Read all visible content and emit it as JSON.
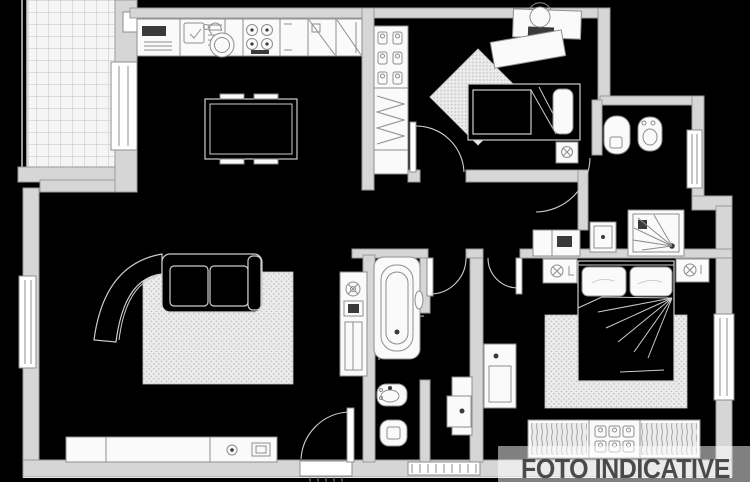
{
  "watermark": {
    "text": "FOTO INDICATIVE"
  },
  "palette": {
    "background": "#000000",
    "wall_fill": "#d6d6d6",
    "wall_stroke": "#9a9a9a",
    "line": "#8d8d8d",
    "line_light": "#cdcdcd",
    "fixture_fill": "#fafafa",
    "dark_fill": "#3a3a3a",
    "rug_fill": "#ececec",
    "rug_dot": "#c4c4c4",
    "tile_fill": "#f5f5f5",
    "tile_line": "#c3c3c3",
    "watermark_color": "#4a4a4a",
    "watermark_band": "rgba(255,255,255,0.5)"
  },
  "rooms": [
    {
      "id": "terrace",
      "features": [
        "tiled-floor",
        "railing",
        "french-door"
      ]
    },
    {
      "id": "kitchen-dining",
      "features": [
        "kitchen-counter",
        "sink",
        "cooktop",
        "appliance-cabinets",
        "kettle",
        "dining-table"
      ]
    },
    {
      "id": "living-room",
      "features": [
        "corner-sofa",
        "rug",
        "sideboard",
        "tv",
        "speaker",
        "shelf-cabinet",
        "plant",
        "window",
        "entrance-door"
      ]
    },
    {
      "id": "bedroom-small",
      "features": [
        "wardrobe-column",
        "single-bed",
        "nightstand",
        "desk",
        "desk-chair",
        "rug",
        "door"
      ]
    },
    {
      "id": "bathroom-main",
      "features": [
        "bathtub",
        "washbasin",
        "toilet",
        "door"
      ]
    },
    {
      "id": "bathroom-second",
      "features": [
        "toilet",
        "bidet",
        "shower",
        "washbasin",
        "window",
        "door"
      ]
    },
    {
      "id": "hallway",
      "features": [
        "console"
      ]
    },
    {
      "id": "corridor",
      "features": [
        "laundry-basin",
        "window",
        "door"
      ]
    },
    {
      "id": "bedroom-master",
      "features": [
        "double-bed",
        "nightstand-left",
        "nightstand-right",
        "rug",
        "wardrobe",
        "dresser",
        "window",
        "door"
      ]
    }
  ]
}
